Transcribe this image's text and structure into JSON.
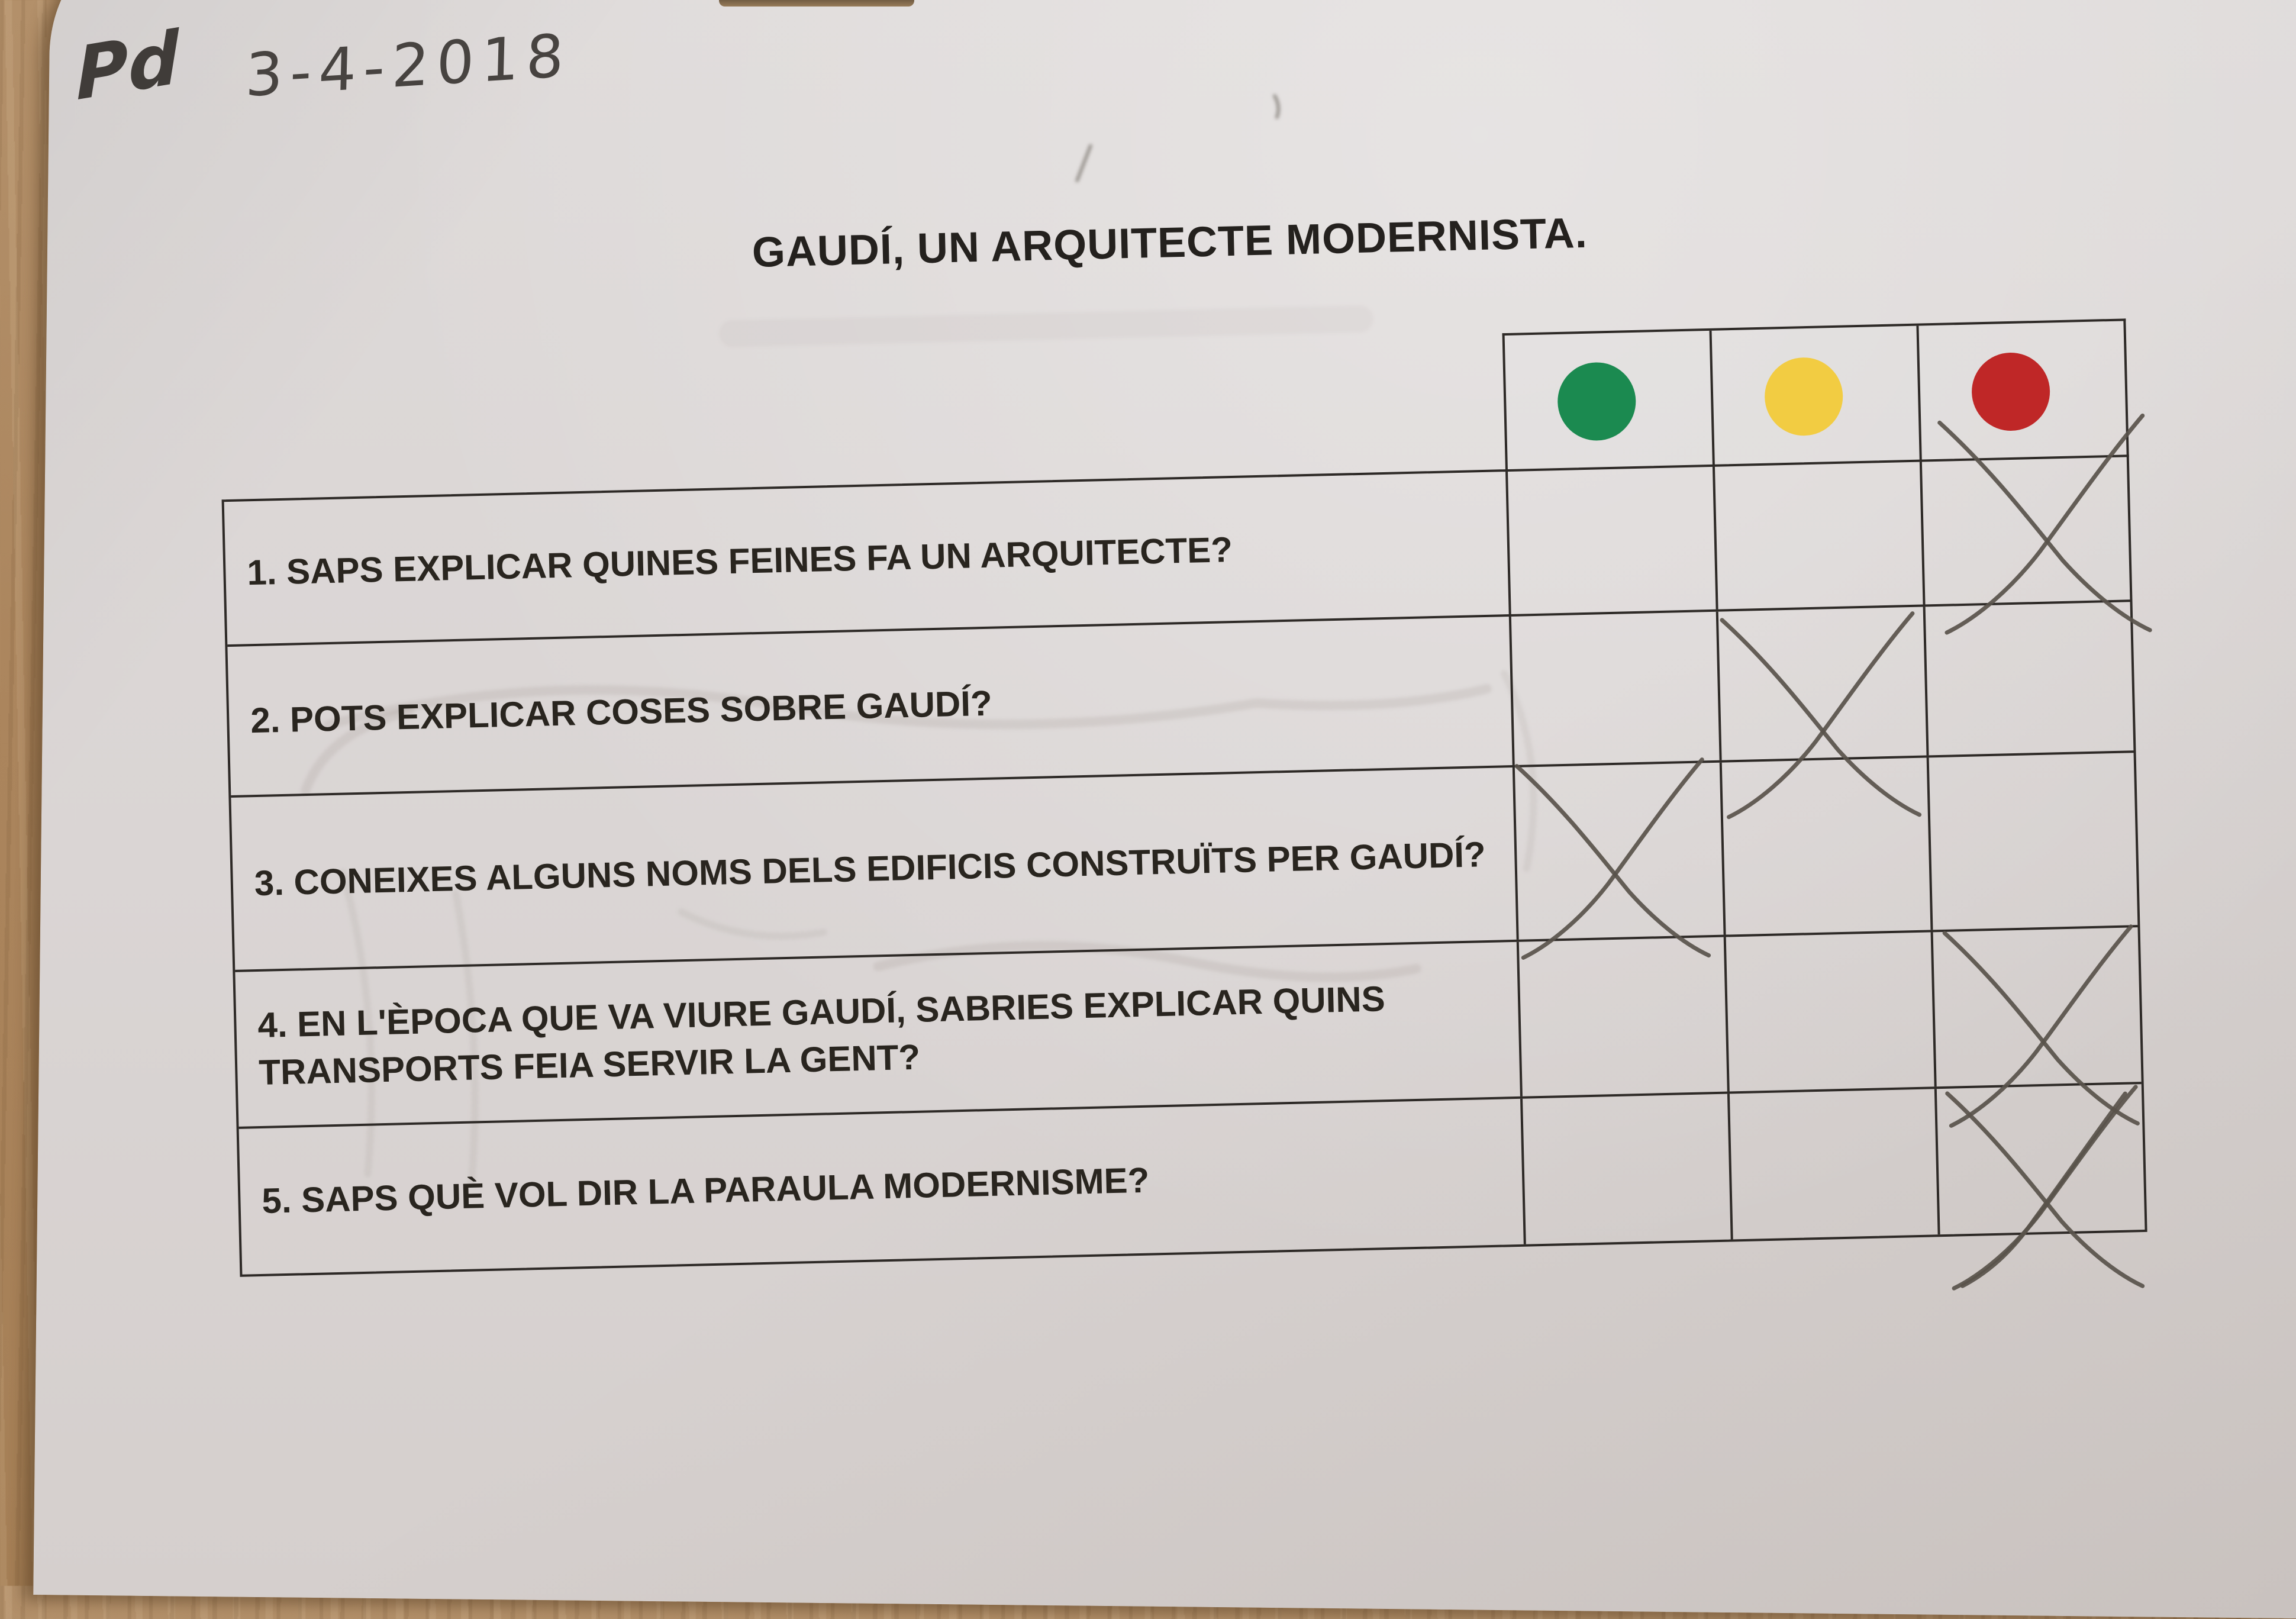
{
  "byline": {
    "initials": "Pd",
    "date": "3-4-2018"
  },
  "title": "GAUDÍ, UN ARQUITECTE MODERNISTA.",
  "legend": {
    "colors": [
      {
        "name": "green",
        "hex": "#1b8a50"
      },
      {
        "name": "yellow",
        "hex": "#f2cc42"
      },
      {
        "name": "red",
        "hex": "#bf2727"
      }
    ]
  },
  "table": {
    "questions": [
      {
        "text": "1. SAPS EXPLICAR QUINES FEINES FA UN ARQUITECTE?",
        "mark": "red"
      },
      {
        "text": "2. POTS EXPLICAR COSES SOBRE GAUDÍ?",
        "mark": "yellow"
      },
      {
        "text": "3. CONEIXES ALGUNS NOMS DELS EDIFICIS CONSTRUÏTS PER GAUDÍ?",
        "mark": "green"
      },
      {
        "text": "4. EN L'ÈPOCA QUE VA VIURE GAUDÍ, SABRIES EXPLICAR QUINS TRANSPORTS FEIA SERVIR LA GENT?",
        "mark": "red"
      },
      {
        "text": "5. SAPS QUÈ VOL DIR LA PARAULA MODERNISME?",
        "mark": "red",
        "mark_style": "double"
      }
    ]
  },
  "pencil_color": "#59534b",
  "paper_color": "#dad5d4",
  "wood_color": "#ab855d"
}
